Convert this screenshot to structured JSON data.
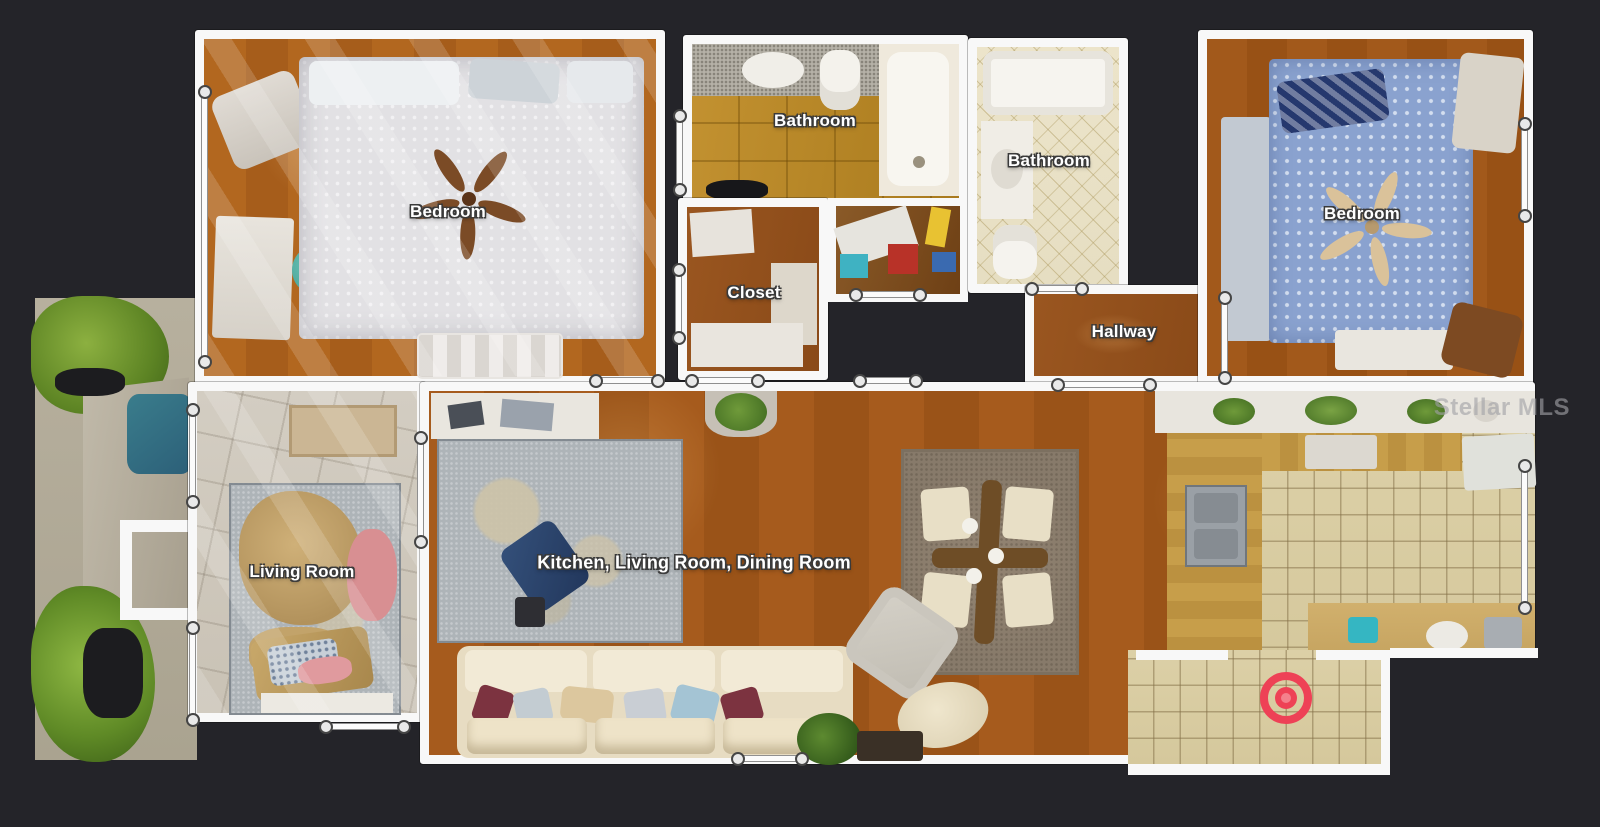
{
  "watermark": {
    "text": "Stellar MLS"
  },
  "rooms": {
    "bedroom_left": {
      "label": "Bedroom"
    },
    "bathroom_main": {
      "label": "Bathroom"
    },
    "bathroom_second": {
      "label": "Bathroom"
    },
    "closet": {
      "label": "Closet"
    },
    "hallway": {
      "label": "Hallway"
    },
    "bedroom_right": {
      "label": "Bedroom"
    },
    "living_room": {
      "label": "Living Room"
    },
    "great_room": {
      "label": "Kitchen, Living Room, Dining Room"
    }
  },
  "colors": {
    "background": "#242429",
    "wall": "#f8f8f8",
    "position_marker": "#ee4156",
    "label_text": "#ffffff",
    "label_outline": "#3a3a3a"
  }
}
